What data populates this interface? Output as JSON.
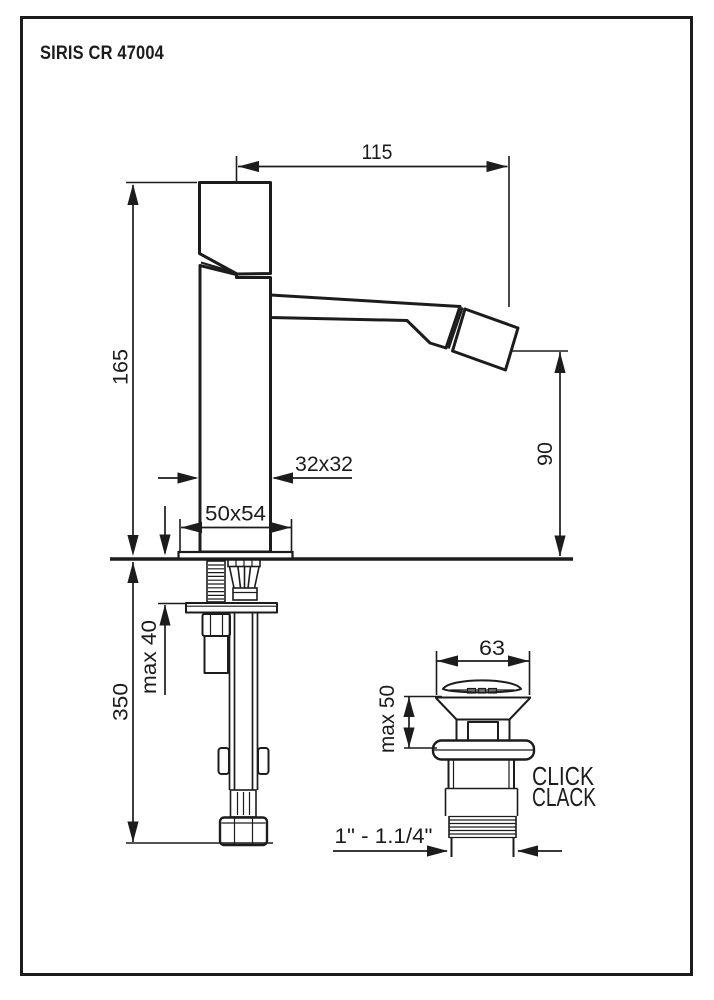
{
  "page": {
    "title": "SIRIS CR 47004"
  },
  "colors": {
    "line": "#1c1c1c",
    "background": "#ffffff"
  },
  "dimensions": {
    "spout_reach": "115",
    "height_above_deck": "165",
    "body_section": "32x32",
    "base_plate": "50x54",
    "spout_height": "90",
    "max_deck_thickness": "max 40",
    "hose_length": "350",
    "drain_cap_diameter": "63",
    "drain_max_height": "max 50",
    "drain_thread": "1\" - 1.1/4\""
  },
  "drain": {
    "type_line1": "CLICK",
    "type_line2": "CLACK"
  }
}
